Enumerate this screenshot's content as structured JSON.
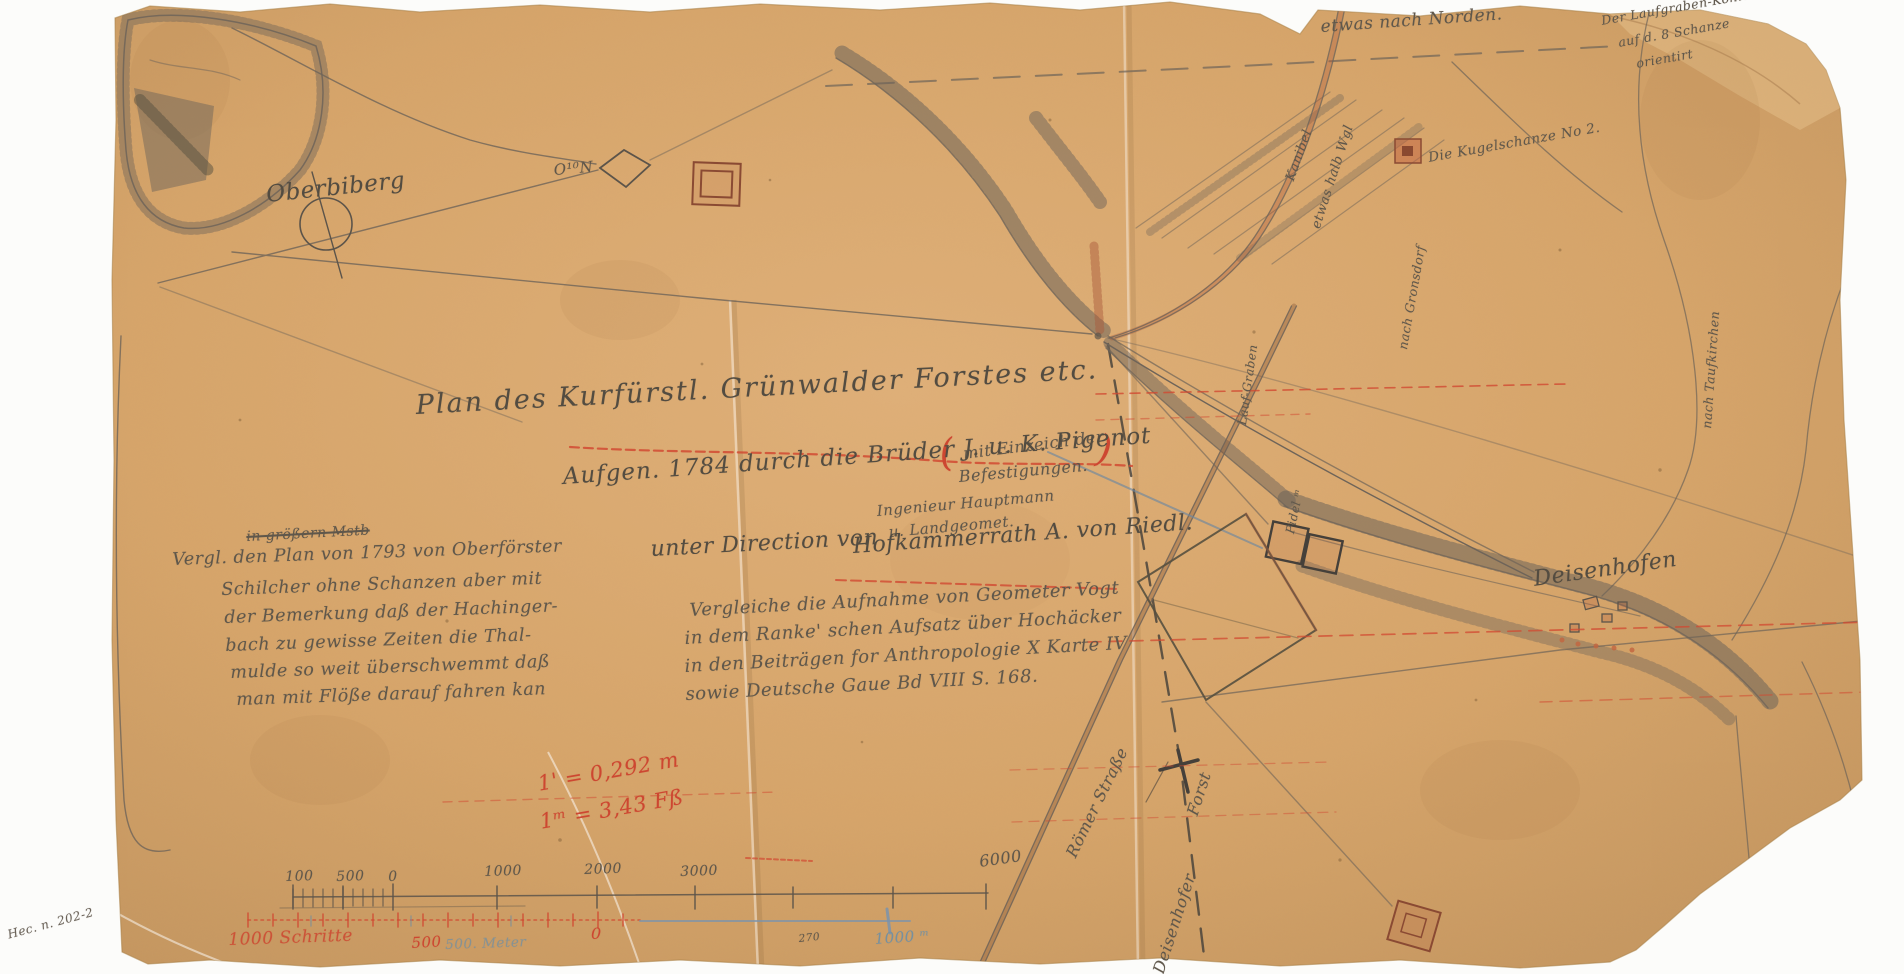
{
  "colors": {
    "paper": "#d9a76c",
    "paper_light": "#e4bd88",
    "pencil": "#6e6459",
    "pencil_dark": "#4c463e",
    "red": "#cd4731",
    "red_brown": "#a8563a",
    "blue": "#76909f",
    "background": "#fcfcfa"
  },
  "title": {
    "line1": "Plan des Kurfürstl. Grünwalder Forstes etc.",
    "paren_open": "(",
    "paren_line1": "mit Einzeich der",
    "paren_line2": "Befestigungen.",
    "paren_close": ")",
    "line2": "Aufgen. 1784 durch die Brüder J. u. K. Pigenot",
    "line3": "Ingenieur Hauptmann",
    "line4": "u. Landgeomet.",
    "line5": "unter Direction von",
    "line6": "Hofkammerrath A. von Riedl."
  },
  "note_1793": {
    "struck": "in größern Mstb",
    "lines": [
      "Vergl. den Plan von 1793 von Oberförster",
      "Schilcher ohne Schanzen aber mit",
      "der Bemerkung daß der Hachinger-",
      "bach zu gewisse Zeiten die Thal-",
      "mulde so weit überschwemmt daß",
      "man mit Flöße darauf fahren kan"
    ]
  },
  "citation": {
    "lines": [
      "Vergleiche die Aufnahme von Geometer Vogt",
      "in dem Ranke' schen Aufsatz über Hochäcker",
      "in den Beiträgen for Anthropologie X Karte IV",
      "sowie Deutsche Gaue Bd VIII S. 168."
    ]
  },
  "scale_notes": {
    "line1": "1' = 0,292 m",
    "line2": "1ᵐ = 3,43 Fß"
  },
  "scale_bar": {
    "pencil_labels": [
      "100",
      "500",
      "0",
      "1000",
      "2000",
      "3000",
      "6000"
    ],
    "red_left": "1000 Schritte",
    "red_mid": "500",
    "blue_mid": "500. Meter",
    "red_zero": "0",
    "small_pencil": "270",
    "blue_right": "1000 ᵐ"
  },
  "places": {
    "oberbiberg": "Oberbiberg",
    "deisenhofen": "Deisenhofen",
    "marker_o10n": "O¹⁰N"
  },
  "annotations": {
    "nach_norden": "etwas nach Norden.",
    "top_right_note": [
      "Der Laufgraben-Köhler",
      "auf d. 8 Schanze",
      "orientirt"
    ],
    "kanal_label": "Kanibel",
    "weg_label": "etwas halb Wgl",
    "kugelschanze": "Die Kugelschanze No 2.",
    "roemer_strasse": "Römer Straße",
    "deisenhofer": "Deisenhofer",
    "forst": "Forst",
    "lauf_graben": "Lauf-Graben",
    "pidel": "Pidel ᵐ",
    "nach_taufkirchen": "nach Taufkirchen",
    "nach_gronsdorf": "nach Gronsdorf",
    "archival_note": "Hec. n. 202-2"
  }
}
